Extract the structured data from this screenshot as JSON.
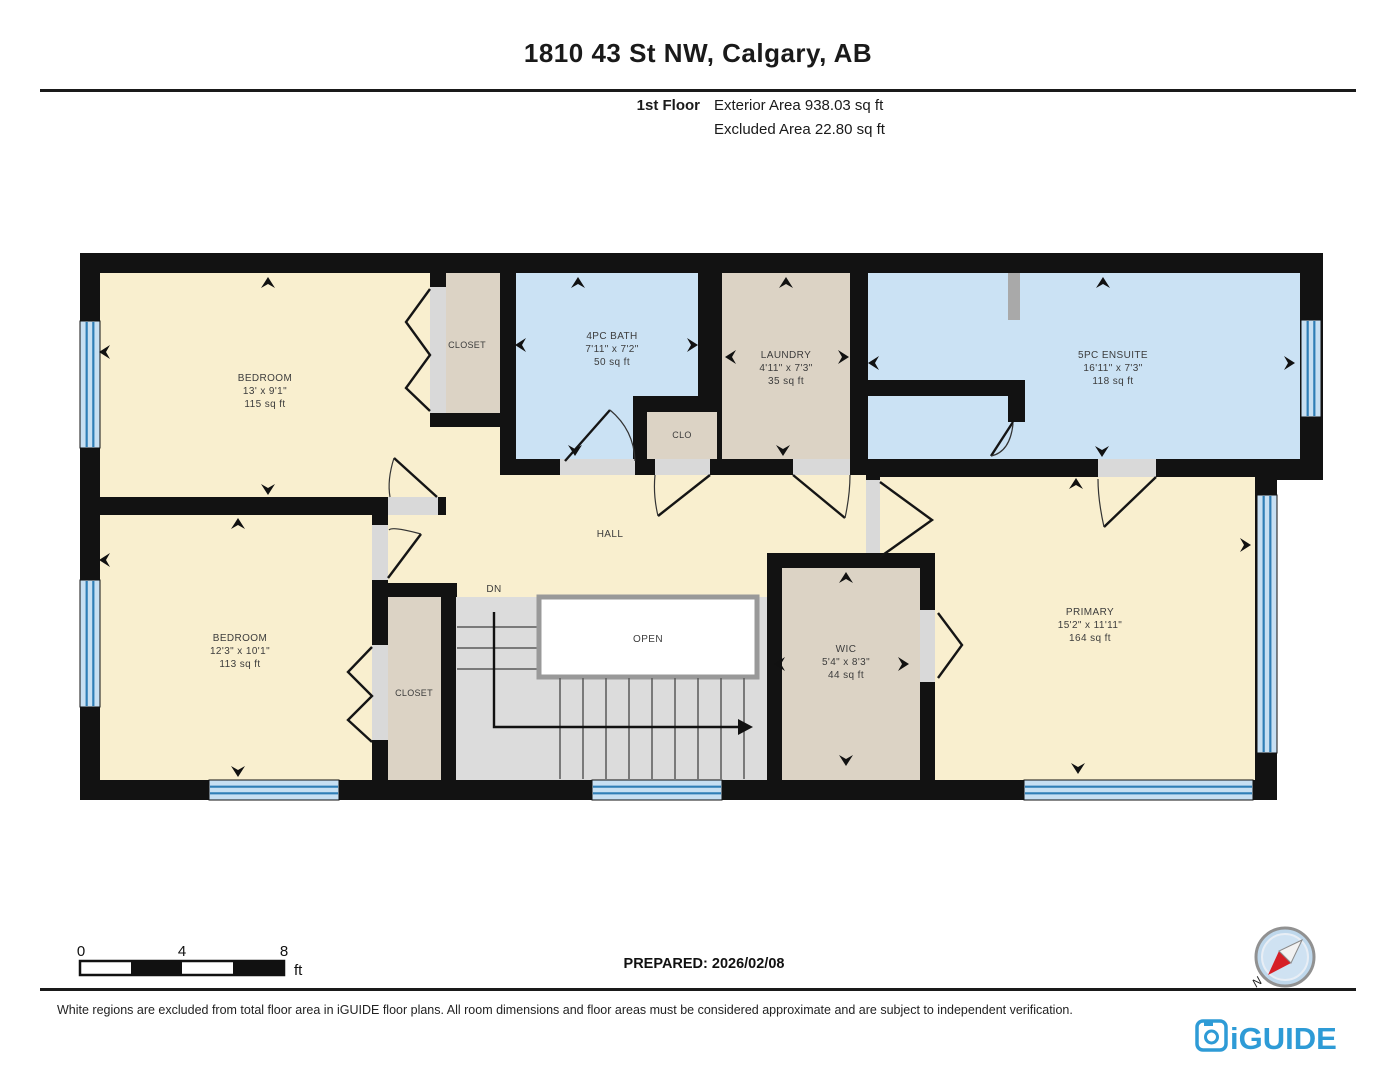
{
  "header": {
    "title": "1810 43 St NW, Calgary, AB",
    "floor_label": "1st Floor",
    "area_line1": "Exterior Area 938.03 sq ft",
    "area_line2": "Excluded Area 22.80 sq ft"
  },
  "rooms": {
    "bedroom_tl": {
      "name": "BEDROOM",
      "dims": "13' x 9'1\"",
      "area": "115 sq ft"
    },
    "closet_tl": {
      "name": "CLOSET"
    },
    "bath": {
      "name": "4PC BATH",
      "dims": "7'11\" x 7'2\"",
      "area": "50 sq ft"
    },
    "clo": {
      "name": "CLO"
    },
    "laundry": {
      "name": "LAUNDRY",
      "dims": "4'11\" x 7'3\"",
      "area": "35 sq ft"
    },
    "ensuite": {
      "name": "5PC ENSUITE",
      "dims": "16'11\" x 7'3\"",
      "area": "118 sq ft"
    },
    "hall": {
      "name": "HALL"
    },
    "stairs": {
      "down_label": "DN",
      "open_label": "OPEN"
    },
    "bedroom_bl": {
      "name": "BEDROOM",
      "dims": "12'3\" x 10'1\"",
      "area": "113 sq ft"
    },
    "closet_bl": {
      "name": "CLOSET"
    },
    "wic": {
      "name": "WIC",
      "dims": "5'4\" x 8'3\"",
      "area": "44 sq ft"
    },
    "primary": {
      "name": "PRIMARY",
      "dims": "15'2\" x 11'11\"",
      "area": "164 sq ft"
    }
  },
  "scale": {
    "ticks": [
      "0",
      "4",
      "8"
    ],
    "unit": "ft"
  },
  "prepared": "PREPARED: 2026/02/08",
  "compass": {
    "north_label": "N"
  },
  "footer": {
    "disclaimer": "White regions are excluded from total floor area in iGUIDE floor plans. All room dimensions and floor areas must be considered approximate and are subject to independent verification.",
    "brand": "iGUIDE"
  },
  "colors": {
    "room_yellow": "#F9EFCF",
    "room_blue": "#CBE2F4",
    "room_beige": "#DCD3C5",
    "wall": "#121212",
    "window_blue": "#2F7EB6",
    "brand_blue": "#2E9BD6"
  }
}
